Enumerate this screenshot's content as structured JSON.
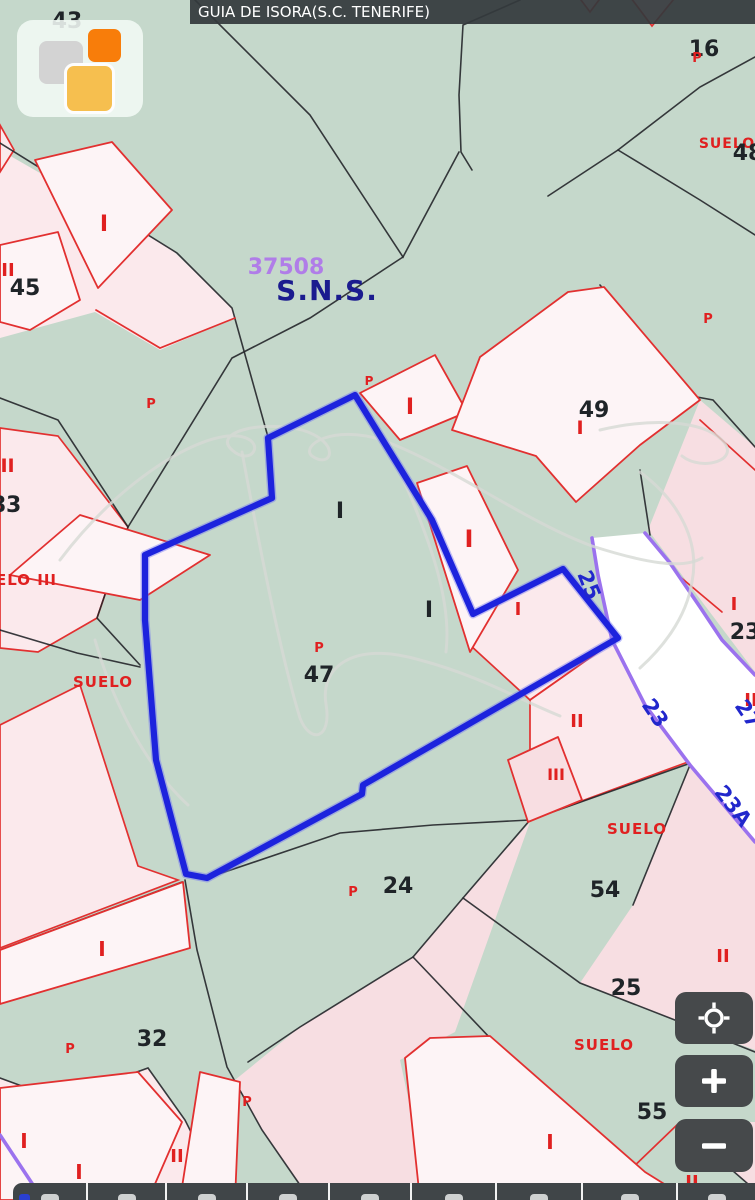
{
  "header": {
    "title": "GUIA DE ISORA(S.C. TENERIFE)"
  },
  "icons": {
    "logo": "catastro-squares-logo",
    "locate": "crosshair-target-icon",
    "zoom_in": "plus-icon",
    "zoom_out": "minus-icon"
  },
  "colors": {
    "map_green": "#c5d8cb",
    "parcel_pink": "#fbe9ec",
    "building_fill": "#fdf4f6",
    "boundary_red": "#e23030",
    "boundary_black": "#23262a",
    "selection_blue": "#1d23dd",
    "road_purple": "#9b72ee",
    "road_number_blue": "#2127cc",
    "reference_purple": "#b07de8",
    "sns_navy": "#1b1b8f",
    "ui_dark": "#46494b",
    "label_red": "#e02020",
    "label_black": "#1f2428"
  },
  "map": {
    "labels": {
      "n43": "43",
      "n16": "16",
      "p_16": "P",
      "suelo_tr": "SUELO",
      "n48": "48",
      "ii_45": "II",
      "n45": "45",
      "i_tl": "I",
      "p_tl": "P",
      "ref": "37508",
      "sns": "S.N.S.",
      "iii_left": "III",
      "n83": "83",
      "suelo_iii": "SUELO III",
      "suelo_left": "SUELO",
      "p_bldg": "P",
      "i_bldg": "I",
      "n49": "49",
      "i_49": "I",
      "p_right": "P",
      "i_c1": "I",
      "i_c2": "I",
      "i_w7": "I",
      "i_pj": "I",
      "p_47": "P",
      "n47": "47",
      "i_r23": "I",
      "n23_right": "23",
      "ii_right": "II",
      "r25": "25",
      "r23": "23",
      "r27": "27",
      "r23a": "23A",
      "ii_mid": "II",
      "iii_mid": "III",
      "suelo_br": "SUELO",
      "p_24": "P",
      "n24": "24",
      "n54": "54",
      "n25": "25",
      "ii_54": "II",
      "i_bl1": "I",
      "p_32": "P",
      "n32": "32",
      "p_bl": "P",
      "i_bl2": "I",
      "i_bl3": "I",
      "ii_bl": "II",
      "suelo_b": "SUELO",
      "n55": "55",
      "i_w6": "I",
      "ii_brc": "II"
    }
  }
}
